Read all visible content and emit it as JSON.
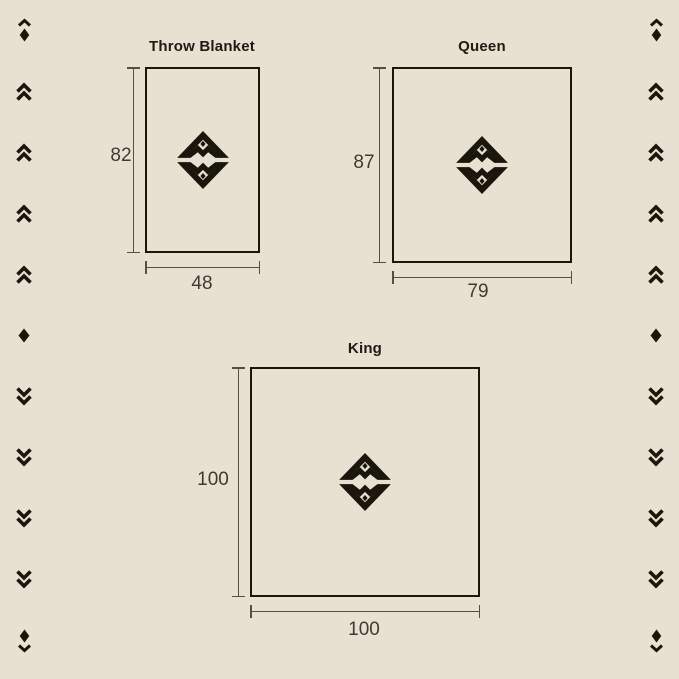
{
  "page": {
    "type": "blanket-size-chart"
  },
  "palette": {
    "background": "#e8e1d2",
    "outline": "#1a160c",
    "dimension_line": "#555047",
    "title_text": "#1e1b14",
    "number_text": "#403b32"
  },
  "sizes": [
    {
      "name": "Throw Blanket",
      "height_in": "82",
      "width_in": "48"
    },
    {
      "name": "Queen",
      "height_in": "87",
      "width_in": "79"
    },
    {
      "name": "King",
      "height_in": "100",
      "width_in": "100"
    }
  ],
  "logo": {
    "name": "diamond-chevron-monogram-logo"
  },
  "side_decorations": {
    "left": [
      "chevron-up-over-diamond",
      "double-chevron-up",
      "double-chevron-up",
      "double-chevron-up",
      "double-chevron-up",
      "diamond",
      "double-chevron-down",
      "double-chevron-down",
      "double-chevron-down",
      "double-chevron-down",
      "diamond-over-chevron-down"
    ],
    "right": [
      "chevron-up-over-diamond",
      "double-chevron-up",
      "double-chevron-up",
      "double-chevron-up",
      "double-chevron-up",
      "diamond",
      "double-chevron-down",
      "double-chevron-down",
      "double-chevron-down",
      "double-chevron-down",
      "diamond-over-chevron-down"
    ]
  }
}
